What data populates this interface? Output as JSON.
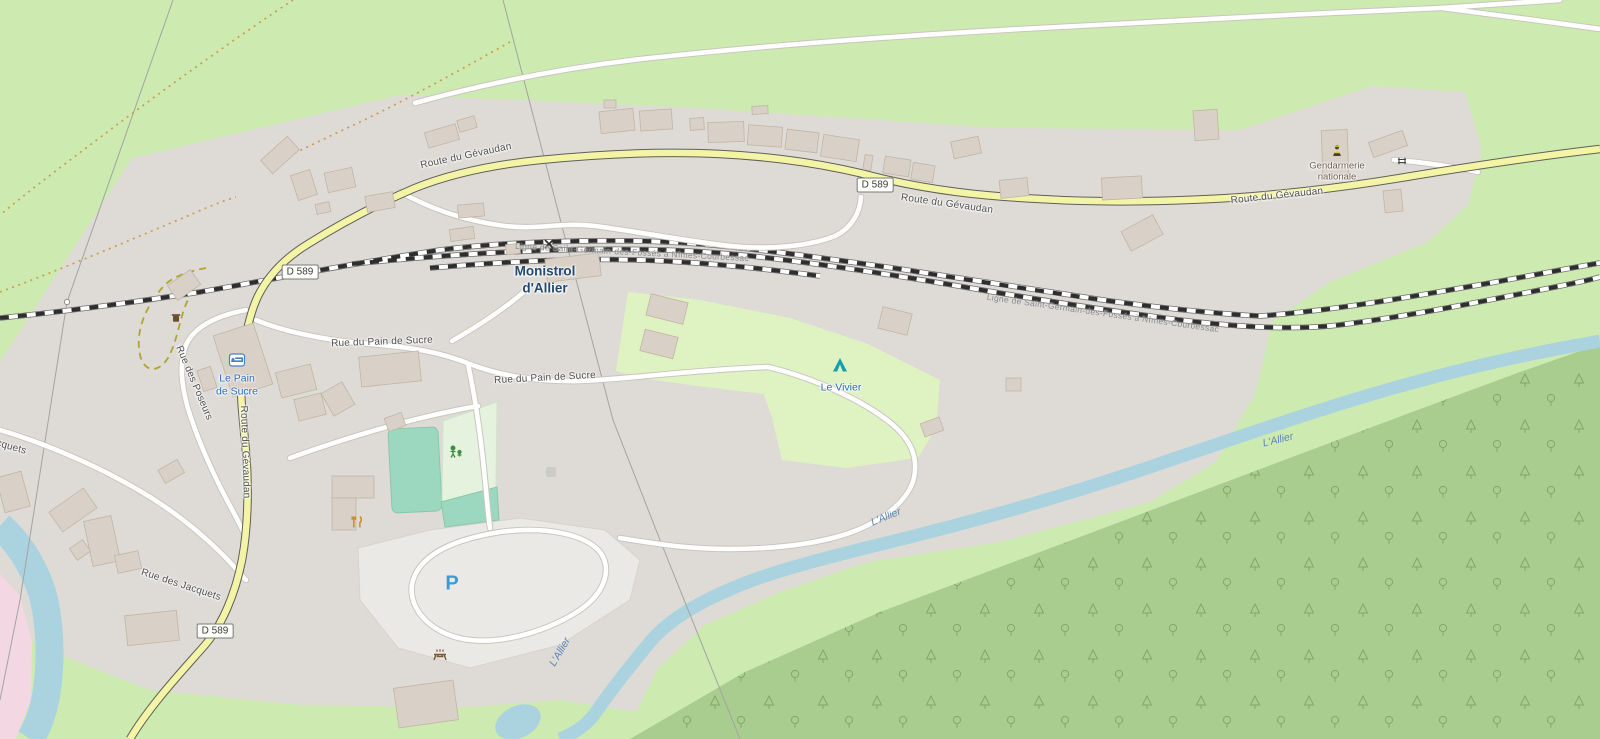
{
  "map_title": "Monistrol-d'Allier village map",
  "labels": {
    "station": [
      "Monistrol",
      "d'Allier"
    ],
    "hotel": [
      "Le Pain",
      "de Sucre"
    ],
    "campsite": "Le Vivier",
    "police": [
      "Gendarmerie",
      "nationale"
    ],
    "parking": "P",
    "shield": "D 589",
    "railway_line": "Ligne de Saint-Germain-des-Fossés à Nîmes-Courbessac",
    "river": "L'Allier",
    "roads": {
      "gevaudan": "Route du Gévaudan",
      "pain_de_sucre": "Rue du Pain de Sucre",
      "poseurs": "Rue des Poseurs",
      "jacquets": "Rue des Jacquets"
    }
  },
  "icons": {
    "station_icon": "railway-station-square",
    "level_crossing_icon": "x-cross",
    "bed_icon": "hotel-bed",
    "tent_icon": "campsite-tent",
    "restaurant_icon": "fork-and-knife",
    "playground_icon": "playground-figures",
    "picnic_icon": "picnic-table",
    "waste_icon": "waste-basket",
    "police_icon": "gendarme-figure",
    "gate_icon": "gate",
    "parking_small_icon": "parking-square"
  },
  "colors": {
    "grass": "#cdebb0",
    "urban": "#dedbd6",
    "forest": "#a9cd8f",
    "campsite_area": "#dff2c2",
    "pitch": "#9cd8c0",
    "playground_area": "#e4f2de",
    "water": "#aad3df",
    "pink_area": "#f3d7e3",
    "building": "#d9d0c7",
    "road_secondary": "#f4f4a6",
    "road_white": "#ffffff",
    "parking_blue": "#3a9bd5",
    "tourism_blue": "#2a6bb8",
    "station_navy": "#25496e",
    "amenity_brown": "#6f6152",
    "street_label": "#4e4e4e",
    "river_label": "#5e87b5"
  }
}
